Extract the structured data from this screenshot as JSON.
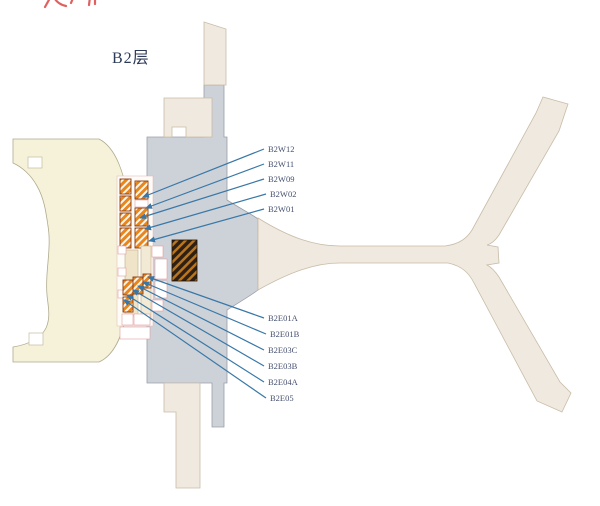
{
  "title": {
    "text": "B2层"
  },
  "annotations": {
    "clipped_red_marks": "partial red pen strokes cut off at top edge",
    "clipped_red_marks_color": "#e06060"
  },
  "colors": {
    "west_concourse_fill": "#f5f2d9",
    "apron_fill": "#f0e9df",
    "terminal_fill": "#cdd1d8",
    "hatch_orange": "#e8861e",
    "hatch_border": "#8a3a10",
    "dark_room_fill": "#2e2013",
    "leader_line": "#3878a8",
    "label_text": "#465070",
    "room_outline_pink": "#e0a0a0"
  },
  "callouts": {
    "west": [
      {
        "label": "B2W12",
        "label_x": 268,
        "label_y": 145,
        "target_x": 143,
        "target_y": 197
      },
      {
        "label": "B2W11",
        "label_x": 268,
        "label_y": 160,
        "target_x": 146,
        "target_y": 208
      },
      {
        "label": "B2W09",
        "label_x": 268,
        "label_y": 175,
        "target_x": 140,
        "target_y": 218
      },
      {
        "label": "B2W02",
        "label_x": 270,
        "label_y": 190,
        "target_x": 145,
        "target_y": 229
      },
      {
        "label": "B2W01",
        "label_x": 268,
        "label_y": 205,
        "target_x": 149,
        "target_y": 241
      }
    ],
    "east": [
      {
        "label": "B2E01A",
        "label_x": 268,
        "label_y": 314,
        "target_x": 148,
        "target_y": 277
      },
      {
        "label": "B2E01B",
        "label_x": 270,
        "label_y": 330,
        "target_x": 143,
        "target_y": 282
      },
      {
        "label": "B2E03C",
        "label_x": 268,
        "label_y": 346,
        "target_x": 138,
        "target_y": 286
      },
      {
        "label": "B2E03B",
        "label_x": 268,
        "label_y": 362,
        "target_x": 133,
        "target_y": 290
      },
      {
        "label": "B2E04A",
        "label_x": 268,
        "label_y": 378,
        "target_x": 127,
        "target_y": 295
      },
      {
        "label": "B2E05",
        "label_x": 270,
        "label_y": 394,
        "target_x": 124,
        "target_y": 300
      }
    ]
  }
}
